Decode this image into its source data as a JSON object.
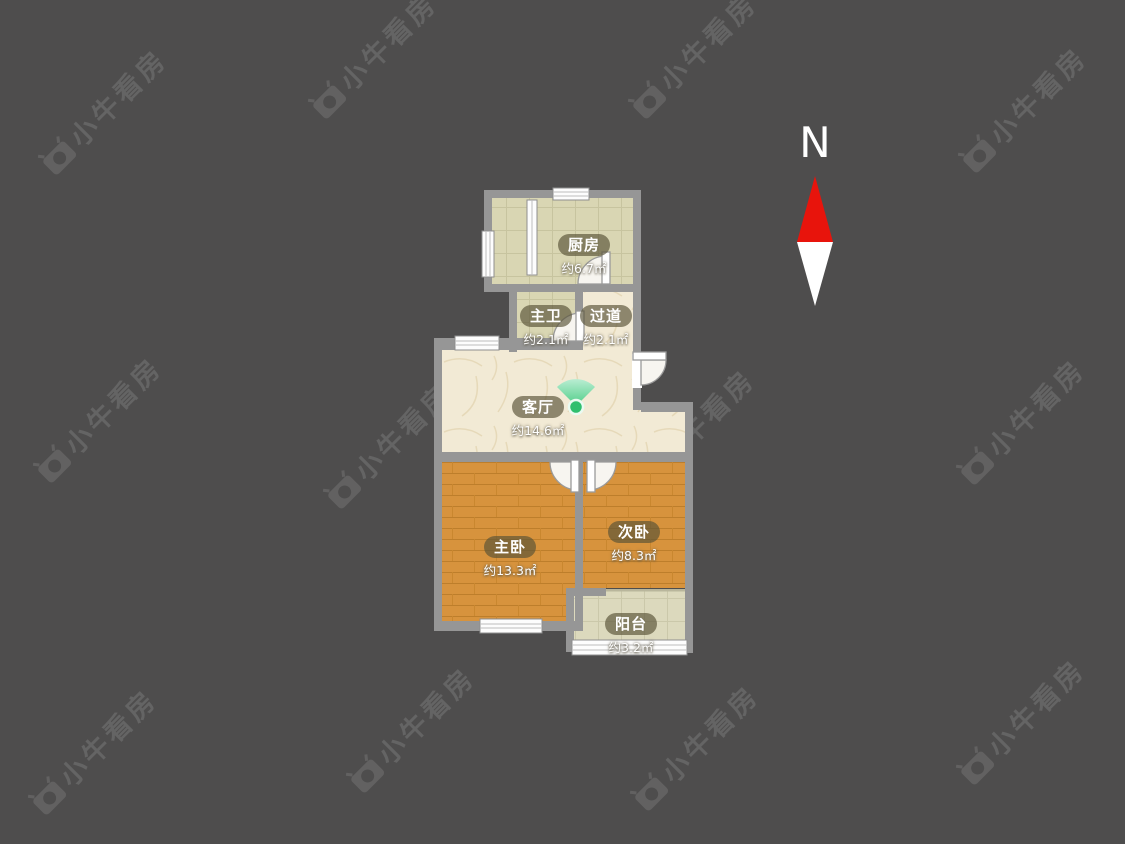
{
  "compass": {
    "label": "N",
    "arrow_top_color": "#e8140c",
    "arrow_bottom_color": "#ffffff"
  },
  "watermark": {
    "text": "小牛看房",
    "positions": [
      {
        "x": 60,
        "y": 172
      },
      {
        "x": 330,
        "y": 116
      },
      {
        "x": 650,
        "y": 116
      },
      {
        "x": 980,
        "y": 170
      },
      {
        "x": 55,
        "y": 480
      },
      {
        "x": 345,
        "y": 506
      },
      {
        "x": 648,
        "y": 492
      },
      {
        "x": 978,
        "y": 482
      },
      {
        "x": 50,
        "y": 812
      },
      {
        "x": 368,
        "y": 790
      },
      {
        "x": 652,
        "y": 808
      },
      {
        "x": 978,
        "y": 782
      }
    ]
  },
  "floorplan": {
    "rooms": {
      "kitchen": {
        "name": "厨房",
        "area": "约6.7㎡"
      },
      "bathroom": {
        "name": "主卫",
        "area": "约2.1㎡"
      },
      "hallway": {
        "name": "过道",
        "area": "约2.1㎡"
      },
      "living": {
        "name": "客厅",
        "area": "约14.6㎡"
      },
      "master": {
        "name": "主卧",
        "area": "约13.3㎡"
      },
      "second": {
        "name": "次卧",
        "area": "约8.3㎡"
      },
      "balcony": {
        "name": "阳台",
        "area": "约3.2㎡"
      }
    },
    "colors": {
      "background": "#4e4d4d",
      "wall": "#969696",
      "floor_cream": "#f2ead5",
      "floor_tile": "#d9d6b3",
      "floor_wood": "#d7933d",
      "floor_balcony": "#dcd9bd",
      "label_pill": "rgba(88,82,55,0.66)",
      "panorama_green": "#2fbf6e"
    }
  }
}
